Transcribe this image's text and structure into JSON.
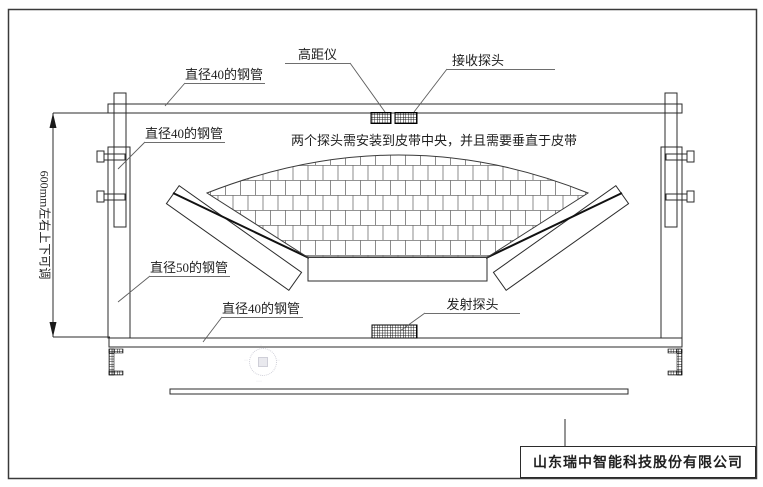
{
  "drawing": {
    "labels": {
      "pipe40_top": "直径40的钢管",
      "pipe40_mid": "直径40的钢管",
      "pipe50_left": "直径50的钢管",
      "pipe40_bottom": "直径40的钢管",
      "height_gauge": "高距仪",
      "receiver_probe": "接收探头",
      "transmitter_probe": "发射探头"
    },
    "annotations": {
      "center_note": "两个探头需安装到皮带中央，并且需要垂直于皮带",
      "adjust_dimension": "600mm左右上下可调"
    },
    "title_block": {
      "company": "山东瑞中智能科技股份有限公司"
    },
    "colors": {
      "main_line": "#2b2b2b",
      "thin_line": "#6e6e6e",
      "text": "#1f1f1f",
      "background": "#ffffff"
    }
  }
}
